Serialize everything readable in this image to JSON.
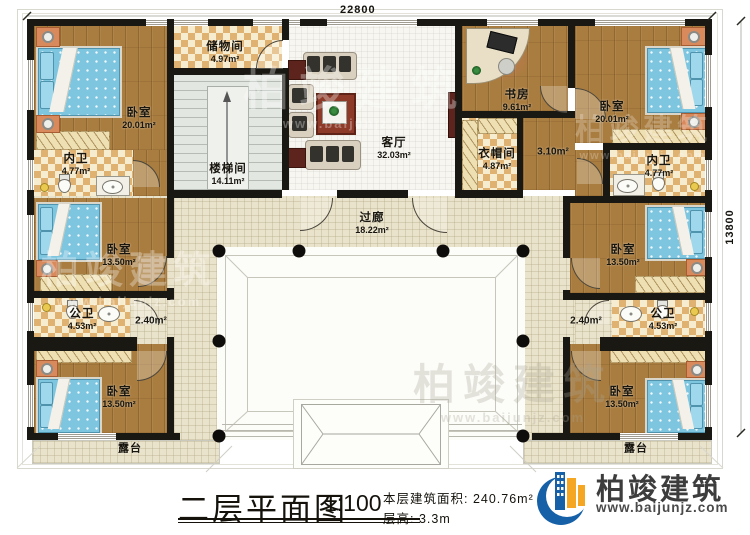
{
  "dimensions": {
    "top": "22800",
    "right": "13800"
  },
  "rooms": {
    "storage": {
      "name": "储物间",
      "area": "4.97m²"
    },
    "stairwell": {
      "name": "楼梯间",
      "area": "14.11m²"
    },
    "living": {
      "name": "客厅",
      "area": "32.03m²"
    },
    "study": {
      "name": "书房",
      "area": "9.61m²"
    },
    "cloakroom": {
      "name": "衣帽间",
      "area": "4.87m²"
    },
    "hall310": {
      "area": "3.10m²"
    },
    "bedroom_tl": {
      "name": "卧室",
      "area": "20.01m²"
    },
    "bath_tl": {
      "name": "内卫",
      "area": "4.77m²"
    },
    "bedroom_tr": {
      "name": "卧室",
      "area": "20.01m²"
    },
    "bath_tr": {
      "name": "内卫",
      "area": "4.77m²"
    },
    "gallery": {
      "name": "过廊",
      "area": "18.22m²"
    },
    "bedroom_ml": {
      "name": "卧室",
      "area": "13.50m²"
    },
    "bath_pl": {
      "name": "公卫",
      "area": "4.53m²"
    },
    "hall240_l": {
      "area": "2.40m²"
    },
    "bedroom_bl": {
      "name": "卧室",
      "area": "13.50m²"
    },
    "terrace_l": {
      "name": "露台"
    },
    "bedroom_mr": {
      "name": "卧室",
      "area": "13.50m²"
    },
    "bath_pr": {
      "name": "公卫",
      "area": "4.53m²"
    },
    "hall240_r": {
      "area": "2.40m²"
    },
    "bedroom_br": {
      "name": "卧室",
      "area": "13.50m²"
    },
    "terrace_r": {
      "name": "露台"
    }
  },
  "title_block": {
    "title": "二层平面图",
    "scale": "1:100",
    "area_line": "本层建筑面积: 240.76m²",
    "height_line": "层高: 3.3m"
  },
  "logo": {
    "name": "柏竣建筑",
    "url": "www.baijunjz.com"
  },
  "watermark": {
    "name": "柏竣建筑",
    "url": "www.baijunjz.com"
  },
  "colors": {
    "wall": "#1a1812",
    "wood": "#a97c3f",
    "corridor": "#eae3cb",
    "checker": "#e0b272",
    "logo_blue": "#1660a8",
    "logo_orange": "#f5a623"
  }
}
